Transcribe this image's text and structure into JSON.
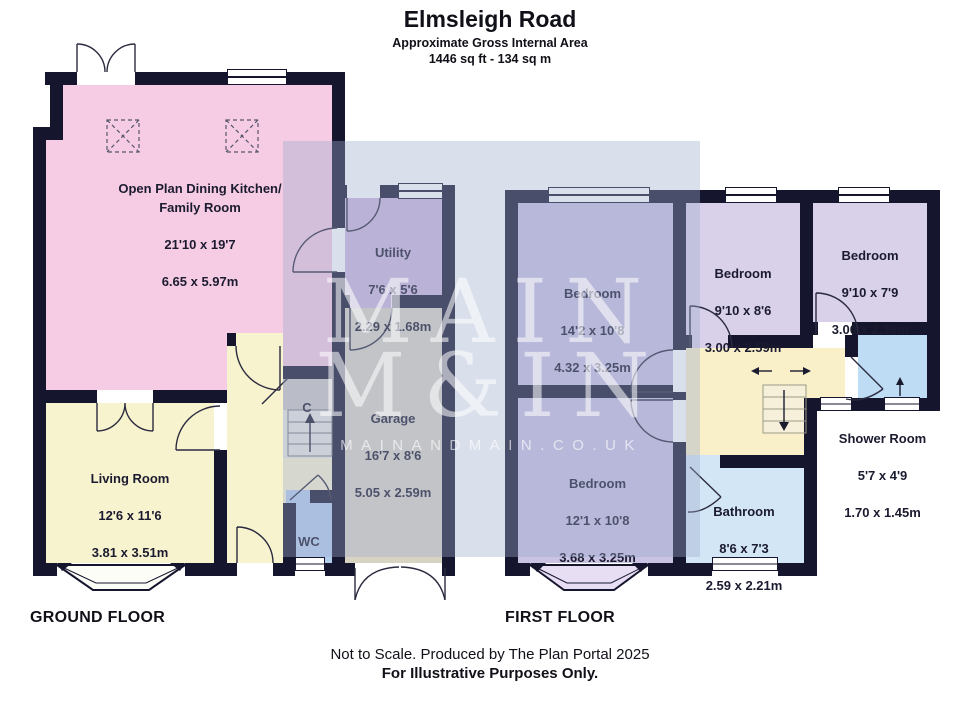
{
  "header": {
    "title": "Elmsleigh Road",
    "subtitle": "Approximate Gross Internal Area",
    "area": "1446 sq ft - 134 sq m"
  },
  "watermark": {
    "line1": "MAIN",
    "line2": "M&IN",
    "line3": "MAINANDMAIN.CO.UK"
  },
  "ground_floor": {
    "label": "GROUND FLOOR",
    "rooms": {
      "kitchen": {
        "name": "Open Plan Dining Kitchen/\nFamily Room",
        "imperial": "21'10 x 19'7",
        "metric": "6.65 x 5.97m"
      },
      "utility": {
        "name": "Utility",
        "imperial": "7'6 x 5'6",
        "metric": "2.29 x 1.68m"
      },
      "garage": {
        "name": "Garage",
        "imperial": "16'7 x 8'6",
        "metric": "5.05 x 2.59m"
      },
      "living": {
        "name": "Living Room",
        "imperial": "12'6 x 11'6",
        "metric": "3.81 x 3.51m"
      },
      "wc": {
        "name": "WC"
      },
      "cupboard": {
        "name": "C"
      }
    }
  },
  "first_floor": {
    "label": "FIRST FLOOR",
    "rooms": {
      "bedroom1": {
        "name": "Bedroom",
        "imperial": "14'2 x 10'8",
        "metric": "4.32 x 3.25m"
      },
      "bedroom2": {
        "name": "Bedroom",
        "imperial": "9'10 x 8'6",
        "metric": "3.00 x 2.59m"
      },
      "bedroom3": {
        "name": "Bedroom",
        "imperial": "9'10 x 7'9",
        "metric": "3.00 x 2.36m"
      },
      "bedroom4": {
        "name": "Bedroom",
        "imperial": "12'1 x 10'8",
        "metric": "3.68 x 3.25m"
      },
      "bathroom": {
        "name": "Bathroom",
        "imperial": "8'6 x 7'3",
        "metric": "2.59 x 2.21m"
      },
      "shower": {
        "name": "Shower Room",
        "imperial": "5'7 x 4'9",
        "metric": "1.70 x 1.45m"
      }
    }
  },
  "footer": {
    "note1": "Not to Scale. Produced by The Plan Portal 2025",
    "note2": "For Illustrative Purposes Only."
  },
  "colors": {
    "wall": "#15152e",
    "kitchen": "#f6cce4",
    "cream": "#f8f3cf",
    "utility": "#cdb9dd",
    "garage": "#d8d4c4",
    "wc": "#b3cdec",
    "gray": "#ccc9c4",
    "stair_gray": "#e9e7e1",
    "bed_dark": "#c9c2e2",
    "bed_light": "#d9d0ea",
    "landing": "#f9efc9",
    "bathroom": "#d3e6f5",
    "shower": "#bedcf4",
    "bay_purple": "#e8def4",
    "watermark": "rgba(159,170,205,0.38)",
    "wm_text": "rgba(255,255,255,0.55)"
  }
}
